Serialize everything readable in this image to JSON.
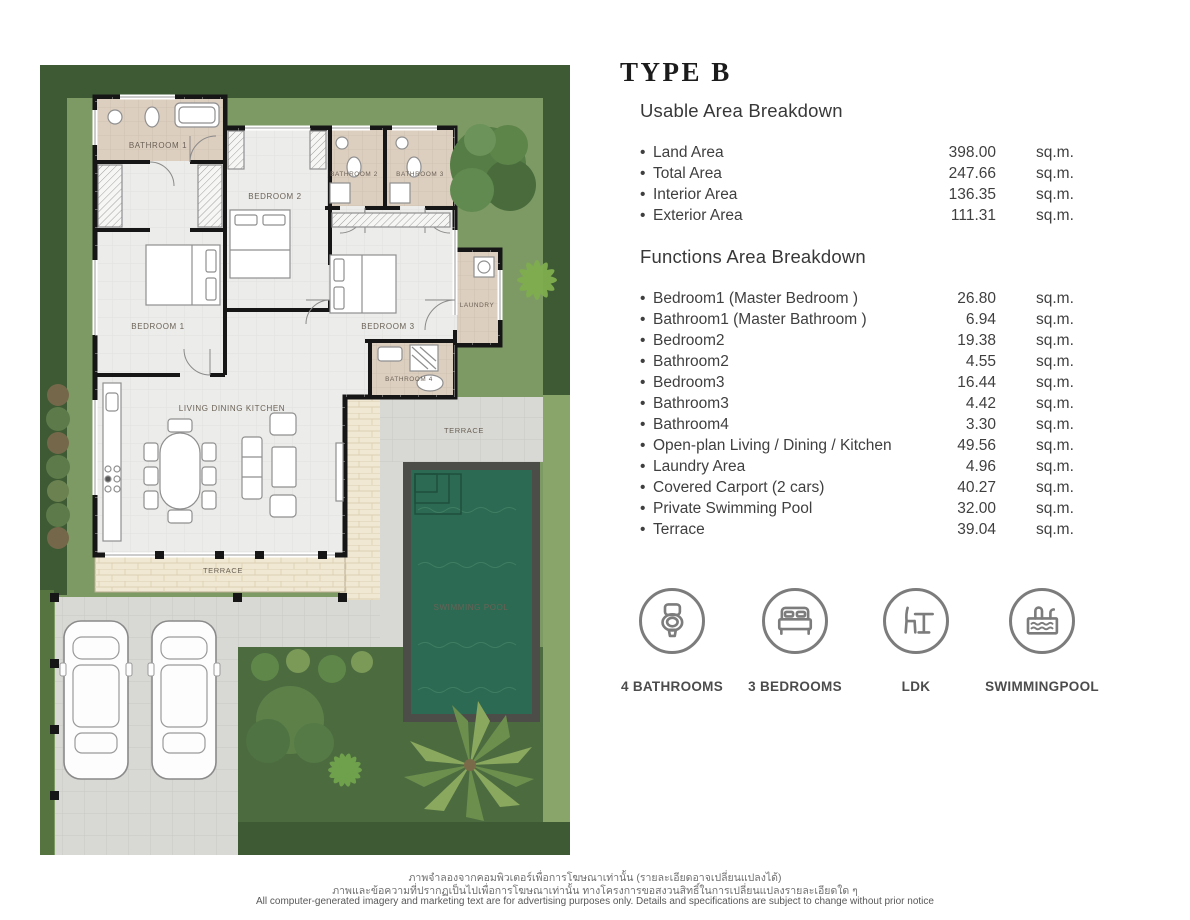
{
  "panel": {
    "title": "TYPE B",
    "bullet": "•",
    "usable": {
      "heading": "Usable Area Breakdown",
      "rows": [
        {
          "label": "Land Area",
          "sub": "",
          "value": "398.00",
          "unit": "sq.m."
        },
        {
          "label": "Total Area",
          "sub": "",
          "value": "247.66",
          "unit": "sq.m."
        },
        {
          "label": "Interior Area",
          "sub": "",
          "value": "136.35",
          "unit": "sq.m."
        },
        {
          "label": "Exterior Area",
          "sub": "",
          "value": "111.31",
          "unit": "sq.m."
        }
      ]
    },
    "functions": {
      "heading": "Functions Area Breakdown",
      "rows": [
        {
          "label": "Bedroom",
          "sub": "1 (Master Bedroom )",
          "value": "26.80",
          "unit": "sq.m."
        },
        {
          "label": "Bathroom",
          "sub": "1 (Master Bathroom )",
          "value": "6.94",
          "unit": "sq.m."
        },
        {
          "label": "Bedroom",
          "sub": "2",
          "value": "19.38",
          "unit": "sq.m."
        },
        {
          "label": "Bathroom",
          "sub": "2",
          "value": "4.55",
          "unit": "sq.m."
        },
        {
          "label": "Bedroom",
          "sub": "3",
          "value": "16.44",
          "unit": "sq.m."
        },
        {
          "label": "Bathroom",
          "sub": "3",
          "value": "4.42",
          "unit": "sq.m."
        },
        {
          "label": "Bathroom",
          "sub": "4",
          "value": "3.30",
          "unit": "sq.m."
        },
        {
          "label": "Open-plan Living / Dining / Kitchen",
          "sub": "",
          "value": "49.56",
          "unit": "sq.m."
        },
        {
          "label": "Laundry Area",
          "sub": "",
          "value": "4.96",
          "unit": "sq.m."
        },
        {
          "label": "Covered Carport (2 cars)",
          "sub": "",
          "value": "40.27",
          "unit": "sq.m."
        },
        {
          "label": "Private Swimming Pool",
          "sub": "",
          "value": "32.00",
          "unit": "sq.m."
        },
        {
          "label": "Terrace",
          "sub": "",
          "value": "39.04",
          "unit": "sq.m."
        }
      ]
    },
    "features": [
      {
        "icon": "toilet-icon",
        "label": "4 BATHROOMS"
      },
      {
        "icon": "bed-icon",
        "label": "3 BEDROOMS"
      },
      {
        "icon": "table-chair-icon",
        "label": "LDK"
      },
      {
        "icon": "pool-icon",
        "label": "SWIMMINGPOOL"
      }
    ]
  },
  "floorplan": {
    "labels": {
      "bathroom1": "BATHROOM 1",
      "bathroom2": "BATHROOM 2",
      "bathroom3": "BATHROOM 3",
      "bathroom4": "BATHROOM 4",
      "bedroom1": "BEDROOM 1",
      "bedroom2": "BEDROOM 2",
      "bedroom3": "BEDROOM 3",
      "laundry": "LAUNDRY",
      "ldk": "LIVING DINING KITCHEN",
      "terrace_bottom": "TERRACE",
      "terrace_right": "TERRACE",
      "swimming_pool": "SWIMMING POOL"
    },
    "colors": {
      "hedge": "#3e5a34",
      "grass": "#7d9a64",
      "lawn_dark": "#4c6c40",
      "pavement": "#d8d8d4",
      "terrace": "#f0e8d2",
      "floor": "#ececea",
      "bath_floor": "#ddcfc0",
      "wall": "#161616",
      "pool_water": "#2d6a53",
      "pool_border": "#4c4c48"
    }
  },
  "footer": {
    "line1": "ภาพจำลองจากคอมพิวเตอร์เพื่อการโฆษณาเท่านั้น  (รายละเอียดอาจเปลี่ยนแปลงได้)",
    "line2": "ภาพและข้อความที่ปรากฏเป็นไปเพื่อการโฆษณาเท่านั้น ทางโครงการขอสงวนสิทธิ์ในการเปลี่ยนแปลงรายละเอียดใด ๆ",
    "line3": "All computer-generated imagery and marketing text are for advertising purposes only. Details and specifications are subject to change without prior notice"
  }
}
